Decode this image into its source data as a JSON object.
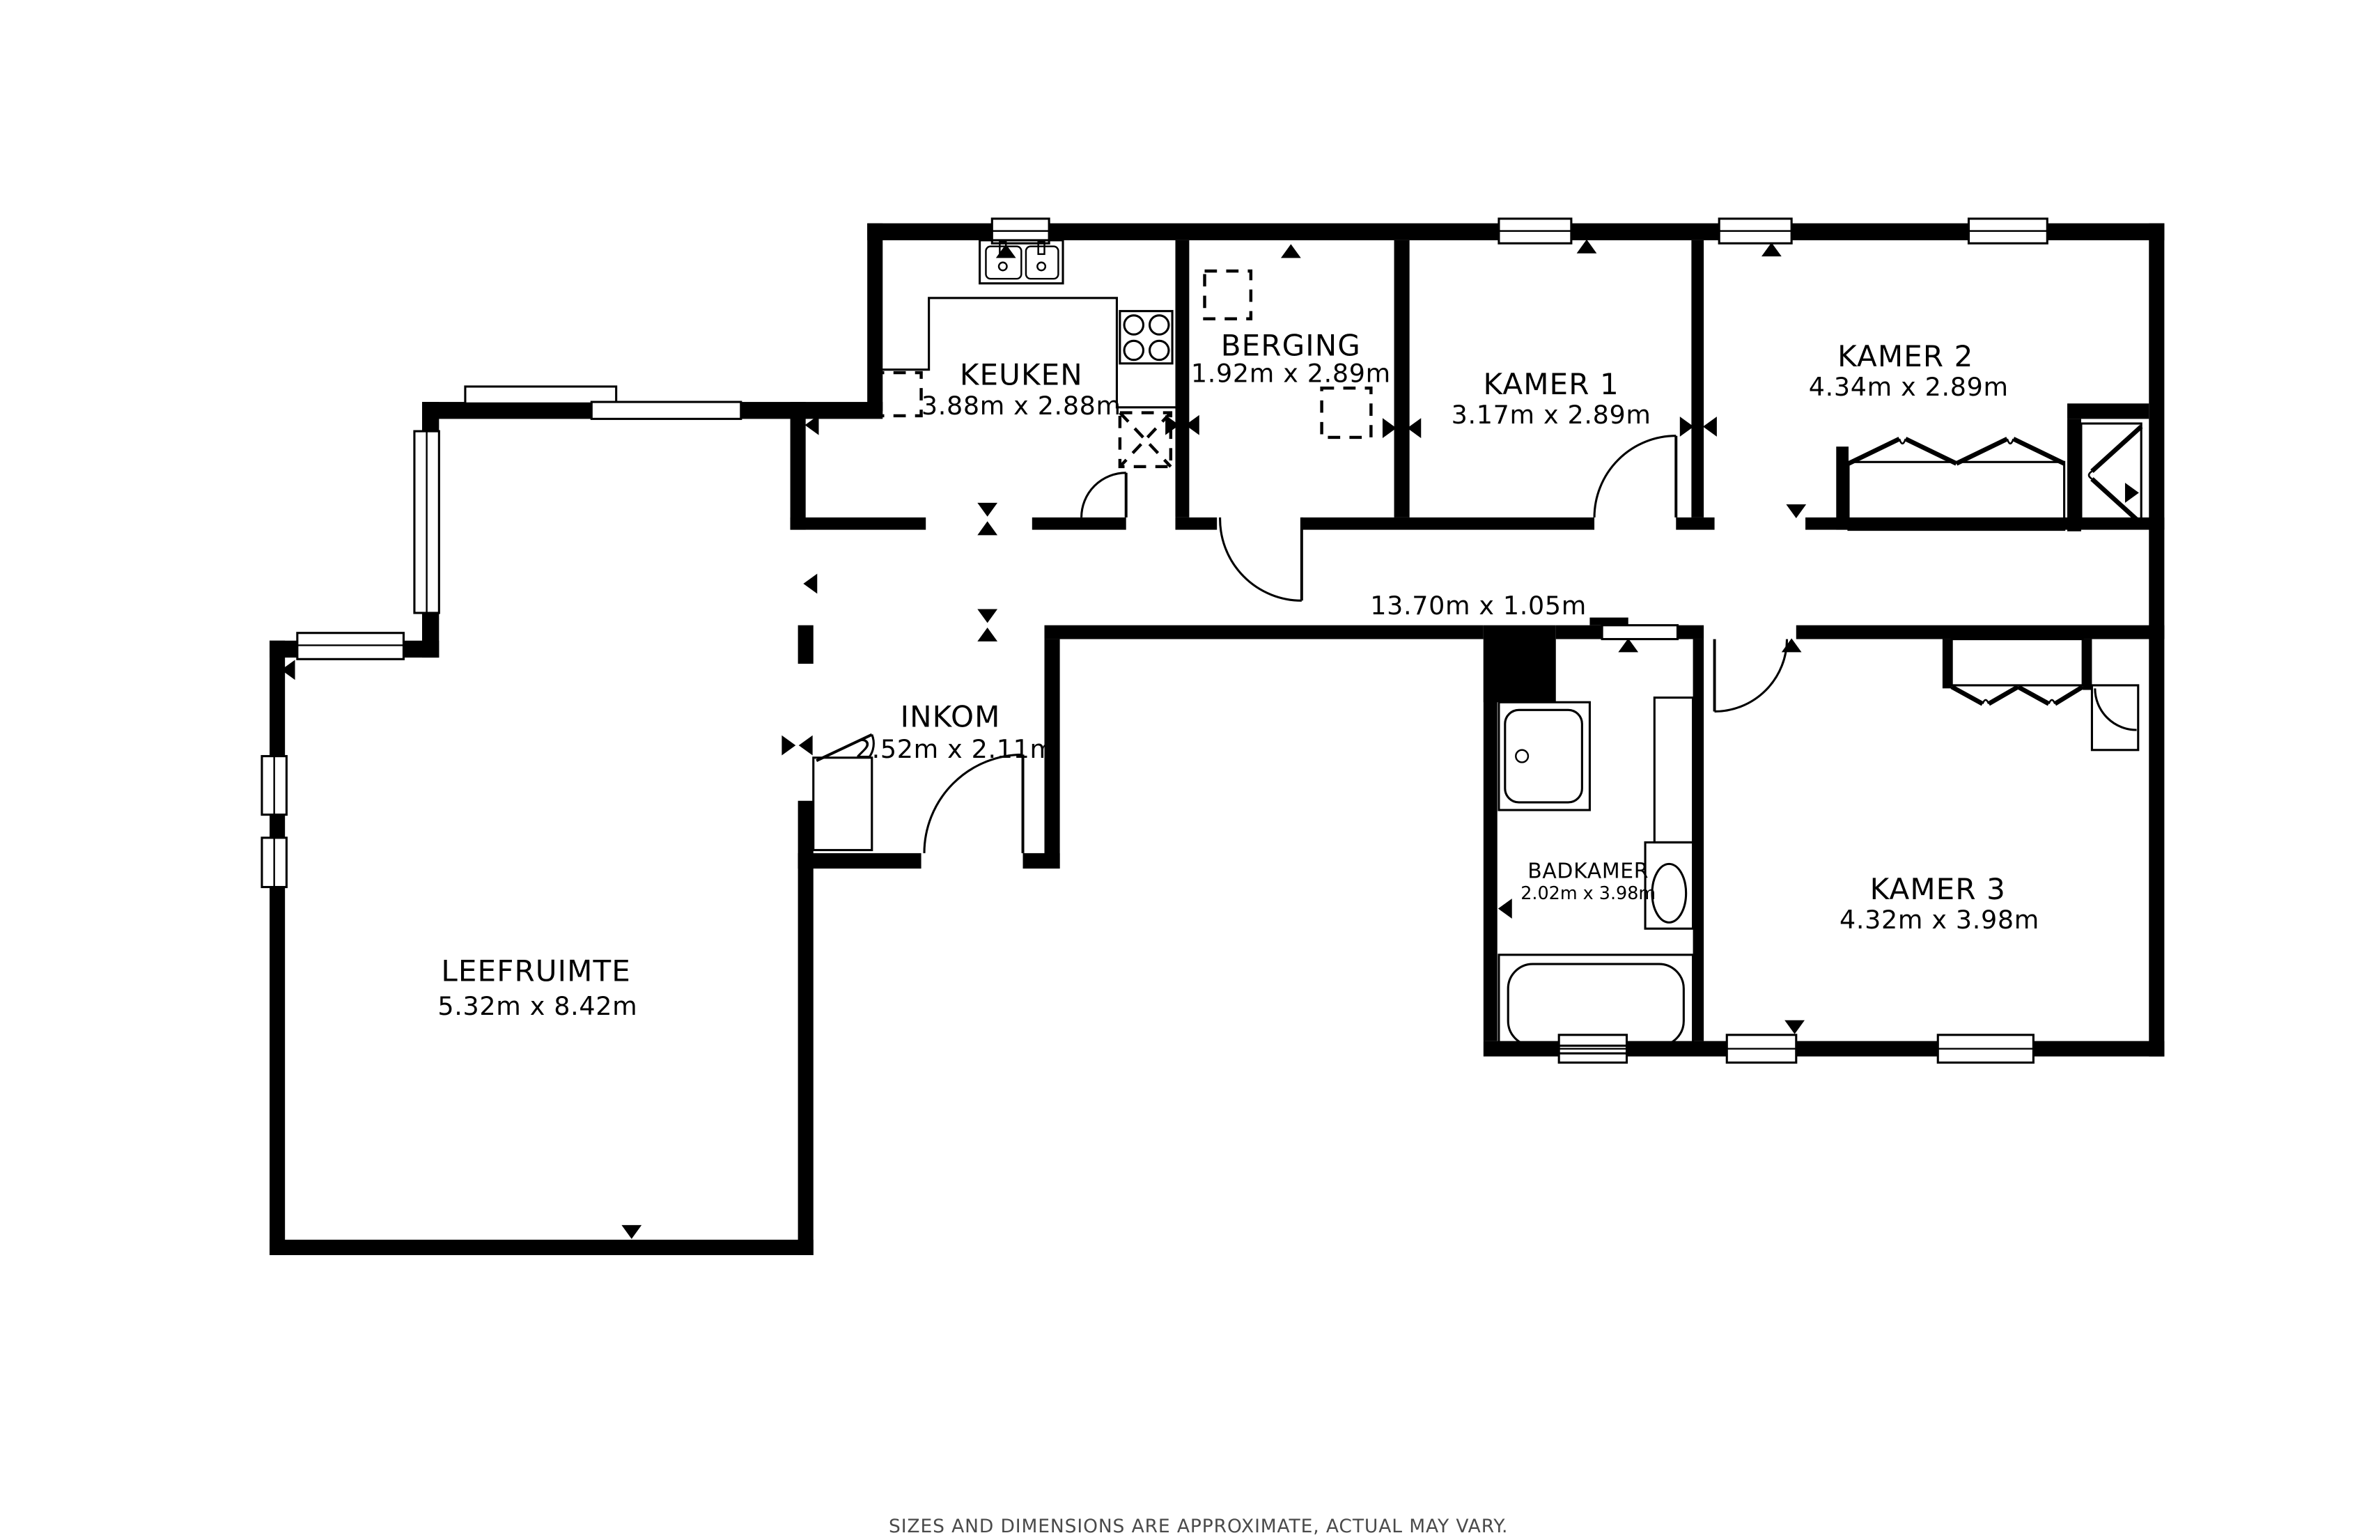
{
  "page": {
    "background": "#ffffff",
    "wall_color": "#000000",
    "disclaimer_color": "#4a4a4a",
    "disclaimer": "SIZES AND DIMENSIONS ARE APPROXIMATE, ACTUAL MAY VARY."
  },
  "rooms": [
    {
      "id": "keuken",
      "name": "KEUKEN",
      "dims": "3.88m x 2.88m"
    },
    {
      "id": "berging",
      "name": "BERGING",
      "dims": "1.92m x 2.89m"
    },
    {
      "id": "kamer1",
      "name": "KAMER 1",
      "dims": "3.17m x 2.89m"
    },
    {
      "id": "kamer2",
      "name": "KAMER 2",
      "dims": "4.34m x 2.89m"
    },
    {
      "id": "inkom",
      "name": "INKOM",
      "dims": "2.52m x 2.11m"
    },
    {
      "id": "badkamer",
      "name": "BADKAMER",
      "dims": "2.02m x 3.98m"
    },
    {
      "id": "kamer3",
      "name": "KAMER 3",
      "dims": "4.32m x 3.98m"
    },
    {
      "id": "leefruimte",
      "name": "LEEFRUIMTE",
      "dims": "5.32m x 8.42m"
    }
  ],
  "corridor": {
    "dims": "13.70m x 1.05m"
  },
  "fixtures": {
    "kitchen": [
      "double-sink",
      "cooktop",
      "counter",
      "appliance-dashed"
    ],
    "bathroom": [
      "washbasin",
      "toilet",
      "bathtub",
      "duct"
    ],
    "bedrooms": [
      "wardrobe",
      "closet-niche"
    ],
    "entry": [
      "closet"
    ]
  }
}
